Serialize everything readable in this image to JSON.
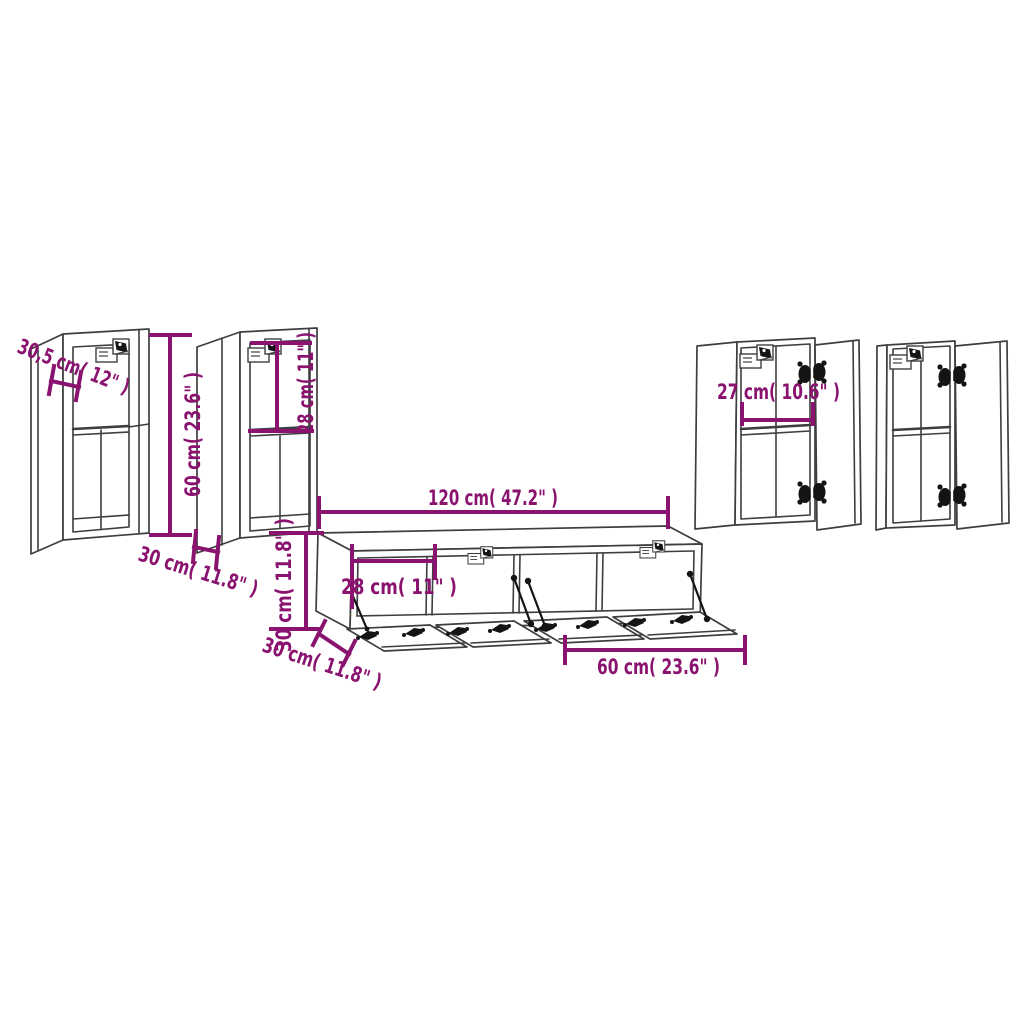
{
  "diagram": {
    "title": "TV wall cabinet set dimension diagram",
    "colors": {
      "background": "#ffffff",
      "line": "#3e3e3e",
      "hardware": "#141414",
      "dimension": "#8b1370"
    },
    "dimensions": {
      "cabinet1_depth": "30,5 cm( 12\" )",
      "cabinet1_height": "60 cm( 23.6\" )",
      "cabinet2_top_section_height": "28 cm( 11\" )",
      "cabinet2_depth": "30 cm( 11.8\" )",
      "tv_stand_total_width": "120 cm( 47.2\" )",
      "tv_stand_compartment_width": "28 cm( 11\" )",
      "tv_stand_height": "30 cm( 11.8\" )",
      "tv_stand_depth": "30 cm( 11.8\" )",
      "tv_stand_unit_width": "60 cm( 23.6\" )",
      "side_cabinet_inner_width": "27 cm( 10.6\" )"
    }
  }
}
